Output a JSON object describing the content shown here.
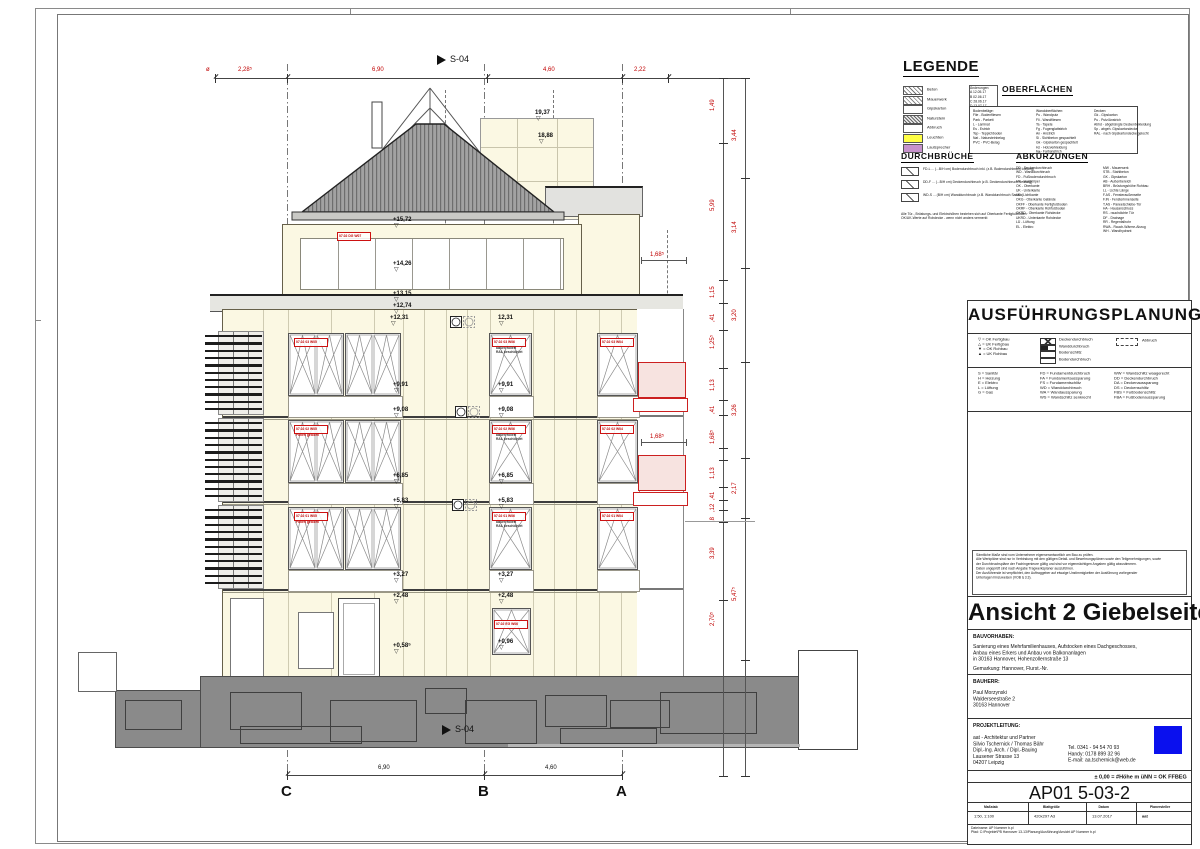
{
  "sheet": {
    "accent_red": "#c00000",
    "facade_color": "#fbf8e3",
    "logo_blue": "#0a10ee"
  },
  "drawing": {
    "section_marker": "S-04",
    "grid_letters": [
      "C",
      "B",
      "A"
    ],
    "top_dim_prefix": "ø",
    "top_dims": [
      "2,28⁵",
      "6,90",
      "4,60",
      "2,22"
    ],
    "bottom_dims": [
      "6,90",
      "4,60"
    ],
    "balcony_dims": [
      "1,68⁵",
      "1,68⁵"
    ],
    "levels": [
      "+15,72",
      "+14,26",
      "+13,15",
      "+12,74",
      "+12,31",
      "12,31",
      "+9,91",
      "+9,91",
      "+9,08",
      "+9,08",
      "+6,85",
      "+6,85",
      "+5,83",
      "+5,83",
      "+3,27",
      "+3,27",
      "+2,48",
      "+2,48",
      "+0,58⁵",
      "+0,96",
      "19,37",
      "18,88"
    ],
    "chain_inner": [
      "1,49",
      "5,99",
      "1,15",
      ",41",
      "1,25⁵",
      "1,13",
      ",41",
      "1,68⁵",
      "1,13",
      ",41",
      ",12",
      ",8",
      "3,39",
      "2,70⁵"
    ],
    "chain_outer": [
      "3,44",
      "3,14",
      "3,20",
      "3,26",
      "2,17",
      "5,47⁵"
    ],
    "window_labels": [
      "07.02 DG W07",
      "07.02 03 W05",
      "07.02 02 W05",
      "07.02 01 W05",
      "07.02 03 W06",
      "07.02 02 W06",
      "07.02 01 W06",
      "07.02 EG W06",
      "07.02 03 W04",
      "07.02 02 W04",
      "07.02 01 W04"
    ],
    "label_sub_single": "Folien gelocht",
    "label_sub_double": [
      "außen foliert",
      "RAL beschichtet"
    ]
  },
  "legend": {
    "title": "LEGENDE",
    "swatches": [
      {
        "label": "Beton",
        "type": "hatch-diag"
      },
      {
        "label": "Mauerwerk",
        "type": "hatch-cross"
      },
      {
        "label": "Gipskarton",
        "type": "plainbox"
      },
      {
        "label": "Naturstein",
        "type": "hatch-dense"
      },
      {
        "label": "Abbruch",
        "type": "plainbox"
      },
      {
        "label": "Leuchten",
        "type": "yellow"
      },
      {
        "label": "Lautsprecher",
        "type": "purple"
      }
    ],
    "oberflaechen_title": "OBERFLÄCHEN",
    "stamp_rows": [
      "Änderungen:",
      "A  12.05.17",
      "B  02.06.17",
      "C  28.06.17",
      "D  13.07.17"
    ],
    "surface_col1": [
      "Bodenbeläge:",
      "Flie - Bodenfliesen",
      "Park - Parkett",
      "L - Laminat",
      "Es - Estrich",
      "Tep - Teppichboden",
      "Nat - Natursteinbelag",
      "PVC - PVC-Belag"
    ],
    "surface_col2": [
      "Wandoberflächen:",
      "Pu - Wandputz",
      "Fli - Wandfliesen",
      "Ta - Tapete",
      "Fg - Fugenglattstrich",
      "An - Anstrich",
      "Si - Sichtbeton gespachtelt",
      "Gk - Gipskarton gespachtelt",
      "Hz - Holzverkleidung",
      "Fa - Farbanstrich"
    ],
    "surface_col3": [
      "Decken:",
      "Gk - Gipskarton",
      "Pu - Putz/Anstrich",
      "Abhd - abgehängte Deckenbekleidung",
      "Sp - abgeh. Gipskartondecke",
      "RAL - nach Gipskartondecke gelocht"
    ],
    "durchbrueche_title": "DURCHBRÜCHE",
    "durchbruch_rows": [
      "FD-L ... (...B/H cm)  Bodendurchbruch inkl. (z.B. Bodendurchbruch Lüftung)",
      "DD-F ... (...B/H cm)  Deckendurchbruch (z.B. Deckendurchbruch Heizung)",
      "WD-S ... (B/H cm)  Wanddurchbruch (z.B. Wanddurchbruch Sanitär)"
    ],
    "durchbruch_notes": [
      "Alle Tür-, Brüstungs- und Elektrohöhen beziehen sich auf Oberkante Fertigfußboden",
      "OK/UK-Werte auf Rohdecke - wenn nicht anders vermerkt"
    ],
    "abkuerzungen_title": "ABKÜRZUNGEN",
    "abk_col1": [
      "DD - Deckendurchbruch",
      "WD - Wanddurchbruch",
      "FD - Fußbodendurchbruch",
      "HK - Heizkörper",
      "OK - Oberkante",
      "UK - Unterkante",
      "LK - Lichtkante",
      "OKG - Oberkante Gelände",
      "OKFF - Oberkante Fertigfußboden",
      "OKRF - Oberkante Rohfußboden",
      "OKRD - Oberkante Rohdecke",
      "UKRD - Unterkante Rohdecke",
      "LÜ - Lüftung",
      "EL - Elektro"
    ],
    "abk_col2": [
      "MW - Mauerwerk",
      "STB - Stahlbeton",
      "GK - Gipskarton",
      "AB - Außenbereich",
      "BRH - Brüstungshöhe Rohbau",
      "LL - Lichte Länge",
      "F.AS - Fensteraußenseite",
      "F.IN - Fensterinnenseite",
      "T.AS - Paneelschiebe-Tür",
      "HA - Hausanschluss",
      "RS - rauchdichte Tür",
      "DF - Drainage",
      "RR - Regenfallrohr",
      "RWA - Rauch-Wärme-Abzug",
      "WH - Wandhydrant"
    ]
  },
  "titleblock": {
    "header": "AUSFÜHRUNGSPLANUNG",
    "sym_col1": [
      "▽ = OK Fertigbau",
      "△ = UK Fertigbau",
      "▼ = OK Rohbau",
      "▲ = UK Rohbau"
    ],
    "sym_col2": [
      "Deckendurchbruch",
      "Wanddurchbruch",
      "Bodenschlitz",
      "Bodendurchbruch"
    ],
    "sym_col3": "Abbruch",
    "trades": [
      "S = Sanitär",
      "H = Heizung",
      "E = Elektro",
      "L = Lüftung",
      "G = Gas"
    ],
    "abbr_a": [
      "FD = Fundamentdurchbruch",
      "FA = Fundamentaussparung",
      "FS = Fundamentschlitz",
      "WD = Wanddurchbruch",
      "WA = Wandaussparung",
      "WS = Wandschlitz senkrecht"
    ],
    "abbr_b": [
      "WW = Wandschlitz waagerecht",
      "DD = Deckendurchbruch",
      "DA = Deckenaussparung",
      "DS = Deckenschlitz",
      "FBS = Fußbodenschlitz",
      "FBA = Fußbodenaussparung"
    ],
    "notes_lines": [
      "Sämtliche Maße sind vom Unternehmer eigenverantwortlich am Bau zu prüfen.",
      "Alle Werkpläne sind nur in Verbindung mit den gültigen Detail- und Bewehrungsplänen sowie den Teilgenehmigungen, sowie",
      "der Durchbruchspläne der Fachingenieure gültig und sind vor eigenmächtigen Angaben gültig abzustimmen.",
      "Daten ungeprüft sind nach Angabe Tragwerksplaner auszuführen.",
      "Der Ausführende ist verpflichtet, den Auftraggeber auf etwaige Unstimmigkeiten der Ausführung vorliegender",
      "Unterlagen hinzuweisen (VOB § 3.3)."
    ],
    "view_title": "Ansicht 2 Giebelseite 01",
    "bauvorhaben_label": "BAUVORHABEN:",
    "bauvorhaben_lines": [
      "Sanierung eines Mehrfamilienhauses, Aufstocken eines Dachgeschosses,",
      "Anbau eines Erkers und Anbau von Balkonanlagen",
      "in 30163 Hannover, Hohenzollernstraße 13"
    ],
    "gemarkung": "Gemarkung: Hannover, Flurst.-Nr.",
    "bauherr_label": "BAUHERR:",
    "bauherr_lines": [
      "Paul Morzynski",
      "Walderseestraße 2",
      "30163 Hannover"
    ],
    "projektleitung_label": "PROJEKTLEITUNG:",
    "pl_address": [
      "aat - Architektur und Partner",
      "Silvio Tschernick / Thomas Bähr",
      "Dipl.-Ing. Arch.  / Dipl.-Bauing",
      "Lausener Strasse 13",
      "04207 Leipzig"
    ],
    "pl_contact": [
      "Tel.      0341 - 94 54 70 93",
      "Handy:  0178 899 32 96",
      "E-mail:  aa.tschernick@web.de"
    ],
    "datum_line": "± 0,00 = #Höhe m üNN = OK FFBEG",
    "plan_no": "AP01 5-03-2",
    "table_headers": [
      "Maßstab",
      "Blattgröße",
      "Datum",
      "Planersteller"
    ],
    "table_values": [
      "1:50, 1:100",
      "420x297 A3",
      "13.07.2017",
      "aat"
    ],
    "footer_lines": [
      "Dateiname: AP Nummer b.pl",
      "Pfad: C:\\Projekte\\PB Hannover 13-13\\Planung\\Ausführung\\Ansicht AP Nummer b.pl"
    ]
  }
}
